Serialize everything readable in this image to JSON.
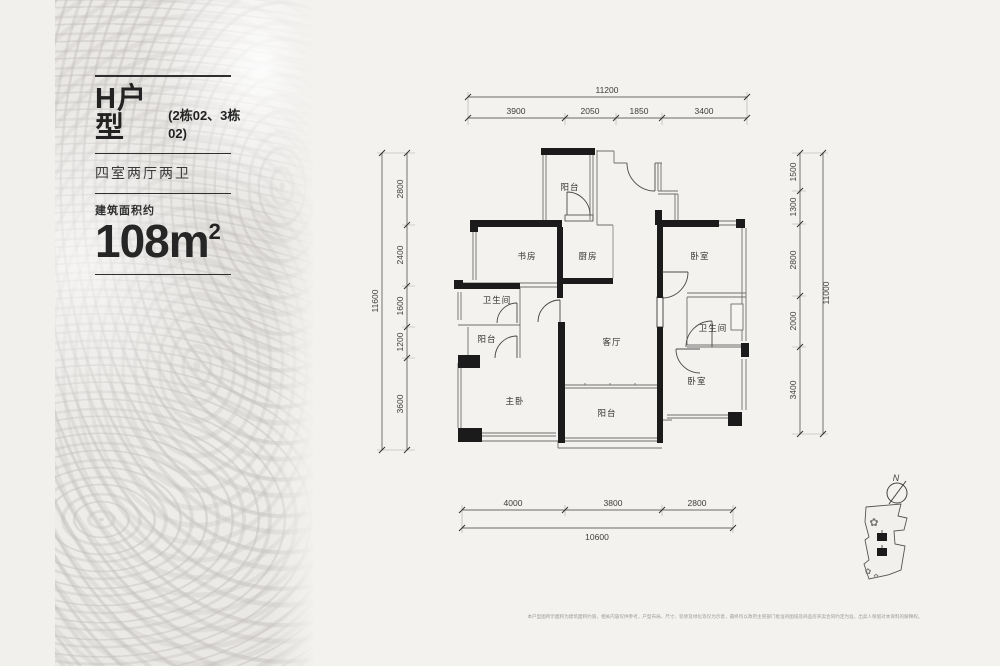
{
  "panel": {
    "title": "H户型",
    "title_note": "(2栋02、3栋02)",
    "layout": "四室两厅两卫",
    "area_label": "建筑面积约",
    "area_value": "108m",
    "area_sup": "2"
  },
  "rooms": {
    "balcony_top": "阳台",
    "study": "书房",
    "kitchen": "厨房",
    "bedroom_ne": "卧室",
    "bath_left": "卫生间",
    "balcony_left": "阳台",
    "living": "客厅",
    "bath_right": "卫生间",
    "master": "主卧",
    "bedroom_se": "卧室",
    "balcony_bottom": "阳台"
  },
  "dims": {
    "top": {
      "total": "11200",
      "segments": [
        "3900",
        "2050",
        "1850",
        "3400"
      ]
    },
    "left": {
      "total": "11600",
      "segments": [
        "2800",
        "2400",
        "1600",
        "1200",
        "3600"
      ]
    },
    "right": {
      "total": "11000",
      "segments": [
        "1500",
        "1300",
        "2800",
        "2000",
        "3400"
      ]
    },
    "bottom": {
      "total": "10600",
      "segments": [
        "4000",
        "3800",
        "2800"
      ]
    }
  },
  "compass": {
    "north": "N"
  },
  "footer": {
    "disclaimer": "本户型图所示面积为建筑面积约值，相关内容仅供参考，户型布局、尺寸、装修及绿化等仅为示意，最终均以政府主管部门批准的图纸及商品房买卖合同约定为准，出卖人保留对本资料的解释权。"
  }
}
